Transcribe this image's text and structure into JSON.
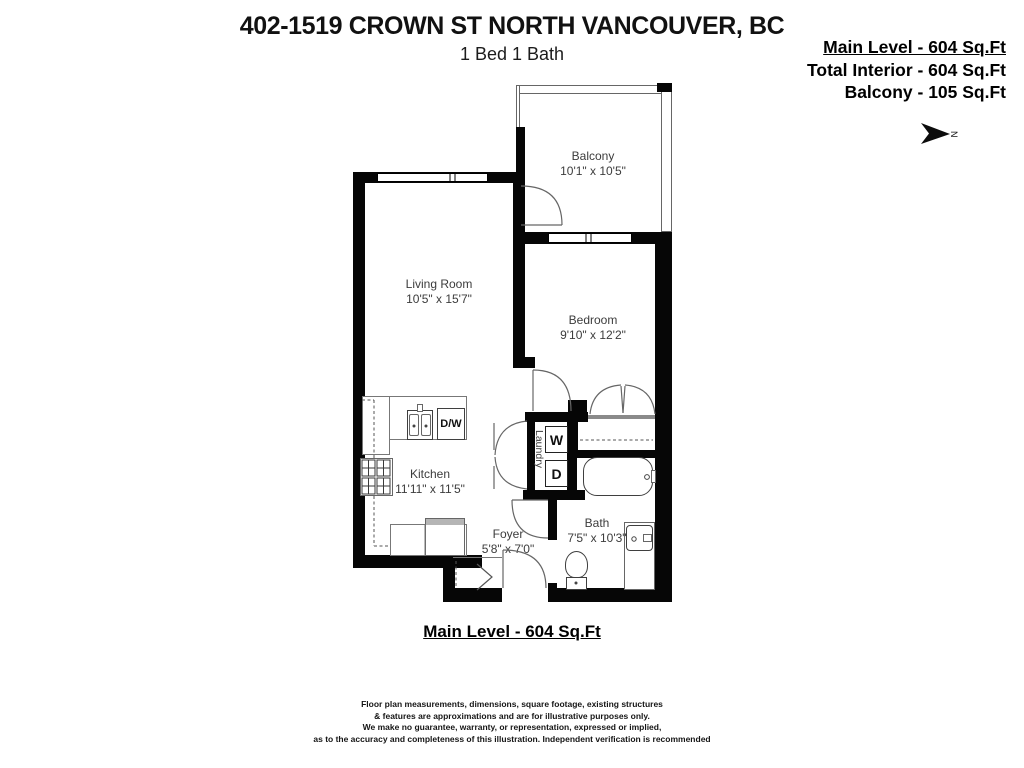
{
  "header": {
    "title": "402-1519 CROWN ST NORTH VANCOUVER, BC",
    "subtitle": "1 Bed 1 Bath"
  },
  "summary": {
    "main_level": "Main Level - 604 Sq.Ft",
    "total_interior": "Total Interior - 604 Sq.Ft",
    "balcony": "Balcony - 105 Sq.Ft"
  },
  "compass": {
    "label": "N"
  },
  "rooms": {
    "balcony": {
      "name": "Balcony",
      "dims": "10'1\" x 10'5\""
    },
    "living": {
      "name": "Living Room",
      "dims": "10'5\" x 15'7\""
    },
    "bedroom": {
      "name": "Bedroom",
      "dims": "9'10\" x 12'2\""
    },
    "kitchen": {
      "name": "Kitchen",
      "dims": "11'11\" x 11'5\""
    },
    "bath": {
      "name": "Bath",
      "dims": "7'5\" x 10'3\""
    },
    "foyer": {
      "name": "Foyer",
      "dims": "5'8\" x 7'0\""
    },
    "laundry": {
      "name": "Laundry"
    }
  },
  "appliances": {
    "dishwasher": "D/W",
    "washer": "W",
    "dryer": "D"
  },
  "footer": {
    "level_label": "Main Level - 604 Sq.Ft",
    "disclaimer": [
      "Floor plan measurements, dimensions, square footage, existing structures",
      "& features are approximations and are for illustrative purposes only.",
      "We make no guarantee, warranty, or representation, expressed or implied,",
      "as to the accuracy and completeness of this illustration. Independent verification is recommended"
    ]
  }
}
